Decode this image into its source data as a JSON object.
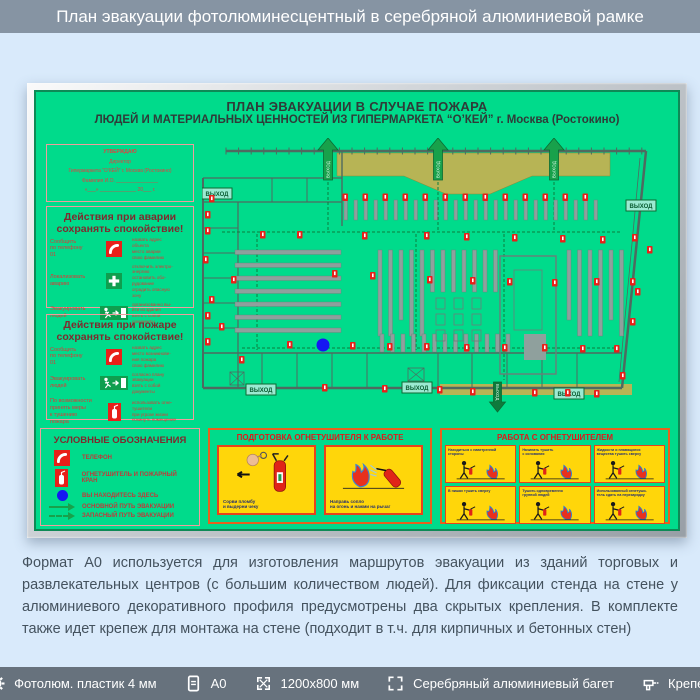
{
  "header": {
    "title": "План эвакуации фотолюминесцентный в серебряной алюминиевой рамке"
  },
  "board": {
    "title1": "ПЛАН ЭВАКУАЦИИ В СЛУЧАЕ ПОЖАРА",
    "title2": "ЛЮДЕЙ И МАТЕРИАЛЬНЫХ ЦЕННОСТЕЙ ИЗ ГИПЕРМАРКЕТА “О’КЕЙ” г. Москва (Ростокино)",
    "approval_lines": [
      "УТВЕРЖДАЮ",
      "Директор",
      "Гипермаркета “О’КЕЙ” г. Москва (Ростокино)",
      "Фамилия И.О. _______________",
      "«___» _____________ 20___ г."
    ],
    "accident": {
      "title": "Действия при аварии",
      "subtitle": "сохранять спокойствие!",
      "rows": [
        {
          "label": "Сообщить\nпо телефону\n01",
          "icon": "phone",
          "notes": "назвать адрес\nобъекта\nместо аварии\nсвою фамилию"
        },
        {
          "label": "Локализовать\nаварию",
          "icon": "cross",
          "notes": "отключить электро-\nэнергию\nостановить обо-\nрудование\nоградить опасную\nзону"
        },
        {
          "label": "Эвакуировать\nлюдей",
          "icon": "exit",
          "notes": "организованно вы-\nйти из здания\nвзять с собой\nдокументы"
        }
      ]
    },
    "fire": {
      "title": "Действия при пожаре",
      "subtitle": "сохранять спокойствие!",
      "rows": [
        {
          "label": "Сообщить\nпо телефону\n01",
          "icon": "phone",
          "notes": "назвать адрес\nместо возникнове-\nния пожара\nсвою фамилию"
        },
        {
          "label": "Эвакуировать\nлюдей",
          "icon": "exit",
          "notes": "согласно плану\nэвакуации\nвзять с собой\nдокументы"
        },
        {
          "label": "По возможности\nпринять меры\nк тушению пожара",
          "icon": "extinguisher",
          "notes": "использовать огне-\nтушители\nпри угрозе жизни\nпокинуть помещение"
        }
      ]
    },
    "legend": {
      "title": "УСЛОВНЫЕ ОБОЗНАЧЕНИЯ",
      "items": [
        {
          "icon": "phone",
          "label": "ТЕЛЕФОН"
        },
        {
          "icon": "extinguisher",
          "label": "ОГНЕТУШИТЕЛЬ И ПОЖАРНЫЙ КРАН"
        },
        {
          "icon": "dot",
          "label": "ВЫ НАХОДИТЕСЬ ЗДЕСЬ"
        },
        {
          "icon": "arrow-solid",
          "label": "ОСНОВНОЙ ПУТЬ ЭВАКУАЦИИ"
        },
        {
          "icon": "arrow-dashed",
          "label": "ЗАПАСНЫЙ ПУТЬ ЭВАКУАЦИИ"
        }
      ]
    },
    "prep_panel": {
      "title": "ПОДГОТОВКА ОГНЕТУШИТЕЛЯ К РАБОТЕ",
      "cards": [
        "Сорви пломбу\nи выдерни чеку",
        "Направь сопло\nна огонь и нажми на рычаг"
      ]
    },
    "work_panel": {
      "title": "РАБОТА С ОГНЕТУШИТЕЛЕМ",
      "cards": [
        "Находиться с наветренной\nстороны",
        "Начинать тушить\nс основания",
        "Жидкости и плавящиеся\nвещества тушить сверху",
        "В нишах тушить сверху",
        "Тушить одновременно\nгруппой людей",
        "Использованный огнетуши-\nтель сдать на перезарядку"
      ]
    },
    "exit_label": "ВЫХОД"
  },
  "plan": {
    "wall_color": "#4f6a60",
    "walls": [
      [
        24,
        13,
        444,
        13,
        2.5
      ],
      [
        444,
        13,
        420,
        250,
        2.5
      ],
      [
        420,
        250,
        1,
        250,
        2.5
      ],
      [
        1,
        40,
        1,
        250,
        2
      ],
      [
        1,
        40,
        140,
        40,
        1.2
      ],
      [
        1,
        64,
        140,
        64,
        1.2
      ],
      [
        36,
        64,
        36,
        250,
        1.2
      ],
      [
        70,
        40,
        70,
        64,
        1
      ],
      [
        105,
        40,
        105,
        64,
        1
      ],
      [
        140,
        13,
        140,
        88,
        1.4
      ],
      [
        1,
        215,
        420,
        215,
        1.4
      ],
      [
        1,
        90,
        36,
        90,
        1
      ],
      [
        1,
        115,
        36,
        115,
        1
      ],
      [
        1,
        140,
        36,
        140,
        1
      ],
      [
        1,
        165,
        36,
        165,
        1
      ],
      [
        1,
        190,
        36,
        190,
        1
      ],
      [
        60,
        215,
        60,
        250,
        1
      ],
      [
        95,
        215,
        95,
        250,
        1
      ],
      [
        130,
        215,
        130,
        250,
        1
      ],
      [
        165,
        215,
        165,
        250,
        1
      ],
      [
        236,
        215,
        236,
        250,
        1
      ],
      [
        270,
        215,
        270,
        250,
        1
      ],
      [
        305,
        215,
        305,
        250,
        1
      ],
      [
        340,
        215,
        340,
        250,
        1
      ],
      [
        375,
        215,
        375,
        250,
        1
      ],
      [
        438,
        20,
        417,
        244,
        0.8
      ]
    ],
    "ticks": {
      "x0": 24,
      "step": 12.6,
      "count": 34,
      "y1": 9.5,
      "y2": 16.5
    },
    "olive_top": "135,15 408,15 408,38 330,38 288,56 244,56 202,38 135,38",
    "olive_bottom": [
      238,
      246,
      192,
      11
    ],
    "dash_lines": [
      [
        20,
        94,
        418,
        94
      ],
      [
        126,
        92,
        126,
        42
      ],
      [
        236,
        92,
        236,
        42
      ],
      [
        352,
        92,
        352,
        42
      ],
      [
        302,
        96,
        302,
        242
      ],
      [
        214,
        96,
        214,
        212
      ],
      [
        55,
        96,
        55,
        212
      ],
      [
        40,
        210,
        415,
        210
      ]
    ],
    "checkouts": {
      "x0": 142,
      "step": 10,
      "count": 26,
      "y": 62,
      "h": 20,
      "w": 3.5
    },
    "vshelves": {
      "x0": 176,
      "step": 10.5,
      "count": 24,
      "y": 112,
      "w": 4
    },
    "vshelves_low": {
      "x0": 178,
      "step": 10.5,
      "count": 13,
      "y": 196,
      "h": 18,
      "w": 4
    },
    "hshelves": {
      "x": 33,
      "w": 106,
      "y0": 112,
      "step": 13,
      "count": 7,
      "h": 4.5
    },
    "minirects": {
      "cols": [
        234,
        252,
        270
      ],
      "rows": [
        160,
        176,
        192
      ],
      "w": 9,
      "h": 11
    },
    "rack": {
      "outer": [
        298,
        118,
        56,
        118
      ],
      "inner": [
        312,
        132,
        28,
        60
      ],
      "block": [
        322,
        196,
        22,
        26
      ]
    },
    "stairs": [
      [
        28,
        234,
        14,
        13
      ],
      [
        206,
        230,
        16,
        13
      ]
    ],
    "arrows_up": [
      126,
      236,
      352
    ],
    "arrow_down": [
      288,
      244
    ],
    "exit_labels": [
      [
        0,
        50
      ],
      [
        424,
        62
      ],
      [
        44,
        246
      ],
      [
        200,
        244
      ],
      [
        352,
        250
      ]
    ],
    "red_icons": [
      [
        7,
        57
      ],
      [
        3,
        73
      ],
      [
        3,
        89
      ],
      [
        1,
        118
      ],
      [
        29,
        138
      ],
      [
        7,
        158
      ],
      [
        3,
        174
      ],
      [
        17,
        185
      ],
      [
        3,
        200
      ],
      [
        58,
        93
      ],
      [
        95,
        93
      ],
      [
        160,
        94
      ],
      [
        222,
        94
      ],
      [
        262,
        95
      ],
      [
        310,
        96
      ],
      [
        358,
        97
      ],
      [
        398,
        98
      ],
      [
        430,
        96
      ],
      [
        130,
        132
      ],
      [
        168,
        134
      ],
      [
        225,
        138
      ],
      [
        268,
        139
      ],
      [
        305,
        140
      ],
      [
        350,
        141
      ],
      [
        392,
        140
      ],
      [
        428,
        140
      ],
      [
        445,
        108
      ],
      [
        85,
        203
      ],
      [
        120,
        204
      ],
      [
        148,
        204
      ],
      [
        185,
        205
      ],
      [
        222,
        205
      ],
      [
        262,
        206
      ],
      [
        300,
        206
      ],
      [
        340,
        206
      ],
      [
        378,
        207
      ],
      [
        412,
        207
      ],
      [
        37,
        218
      ],
      [
        433,
        150
      ],
      [
        428,
        180
      ],
      [
        120,
        246
      ],
      [
        180,
        247
      ],
      [
        235,
        248
      ],
      [
        268,
        250
      ],
      [
        330,
        251
      ],
      [
        363,
        251
      ],
      [
        392,
        252
      ],
      [
        418,
        234
      ]
    ],
    "you_are_here": [
      121,
      207,
      6.5
    ],
    "shelf_fill": "#8fa09d",
    "shelf_stroke": "#6b7d79",
    "olive": "#b7b455",
    "red": "#e82019",
    "green_path": "#0c7c3e",
    "arrow_fill": "#18a14b",
    "arrow_stroke": "#0b6b33",
    "exit_label_bg": "#9bead2",
    "exit_text": "#0a5c32",
    "dot_blue": "#1616f2"
  },
  "description": {
    "text": "Формат А0 используется для изготовления маршрутов эвакуации из зданий торговых и развлекательных центров (с большим количеством людей). Для фиксации стенда на стене у алюминиевого декоративного профиля предусмотрены два скрытых крепления. В комплекте также идет крепеж для монтажа на стене (подходит в т.ч. для кирпичных и бетонных стен)"
  },
  "footer": {
    "items": [
      {
        "icon": "gear-icon",
        "label": "Фотолюм. пластик 4 мм"
      },
      {
        "icon": "document-icon",
        "label": "А0"
      },
      {
        "icon": "dimensions-icon",
        "label": "1200х800 мм"
      },
      {
        "icon": "frame-icon",
        "label": "Серебряный алюминиевый багет"
      },
      {
        "icon": "drill-icon",
        "label": "Крепеж"
      }
    ]
  },
  "colors": {
    "header_bg": "#8694a3",
    "page_bg": "#d9eafb",
    "footer_bg": "#67727d",
    "board_green": "#00db8b",
    "frame_silver": "#c9ccd0",
    "accent_red": "#e82019",
    "panel_yellow": "#ffd60a",
    "panel_border": "#e8421c"
  }
}
